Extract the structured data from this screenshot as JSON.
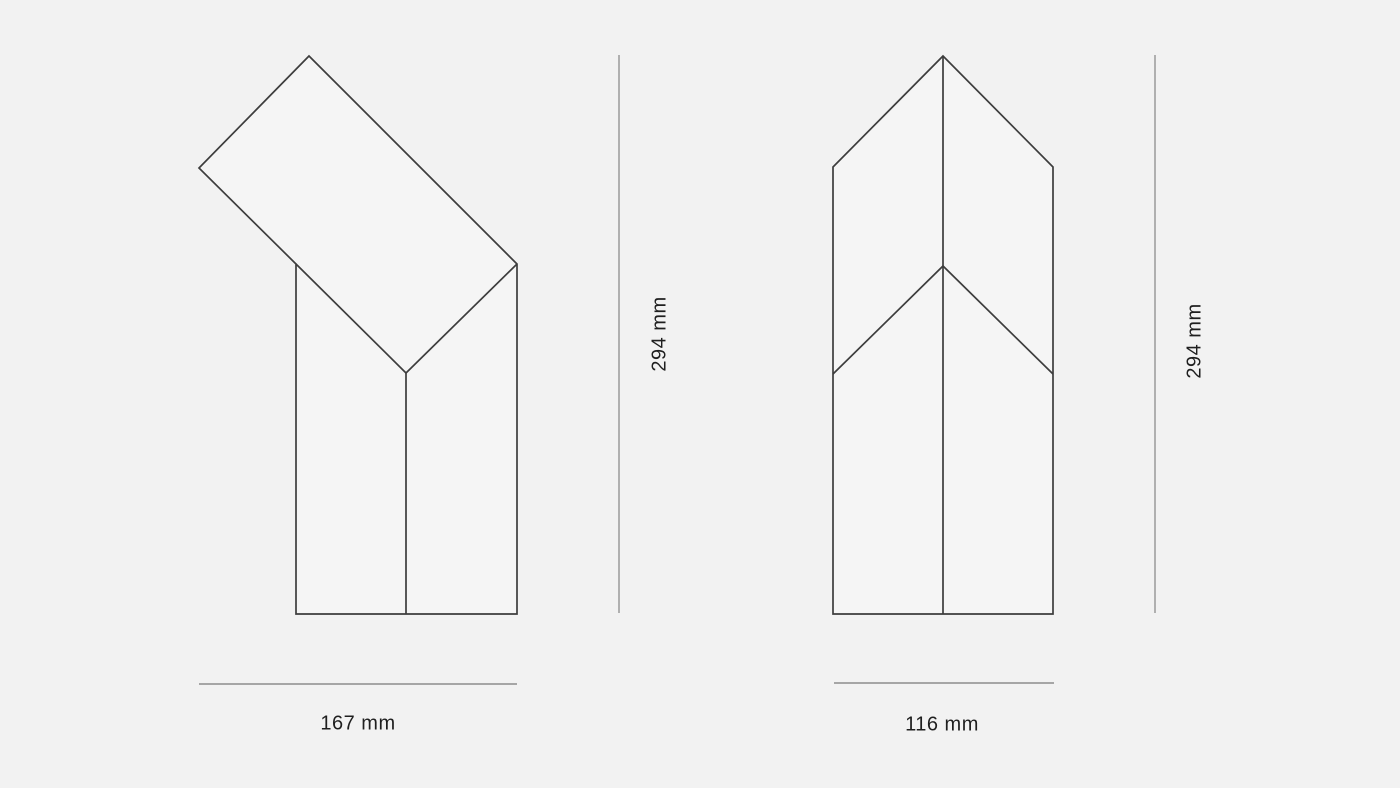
{
  "colors": {
    "background": "#f2f2f2",
    "shape_fill": "#f5f5f5",
    "outline": "#3d3d3d",
    "vertical_dimension_line": "#8c8c8c",
    "horizontal_dimension_line": "#5a5a5a",
    "label_text": "#1f1f1f"
  },
  "views": {
    "side_view": {
      "height_label": "294 mm",
      "width_label": "167 mm"
    },
    "front_view": {
      "height_label": "294 mm",
      "width_label": "116 mm"
    }
  }
}
